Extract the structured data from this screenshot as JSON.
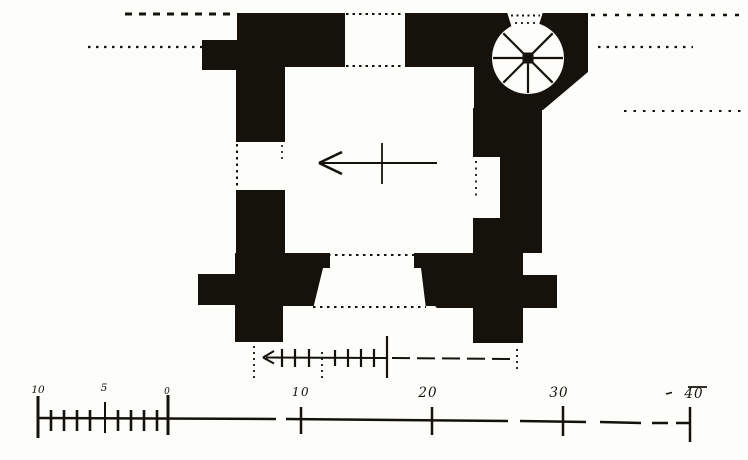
{
  "colors": {
    "ink": "#15120b",
    "paper": "#fdfdfa"
  },
  "main_scale": {
    "labels": [
      {
        "text": "10"
      },
      {
        "text": "5"
      },
      {
        "text": "0"
      },
      {
        "text": "10"
      },
      {
        "text": "20"
      },
      {
        "text": "30"
      },
      {
        "text": "40"
      }
    ]
  }
}
